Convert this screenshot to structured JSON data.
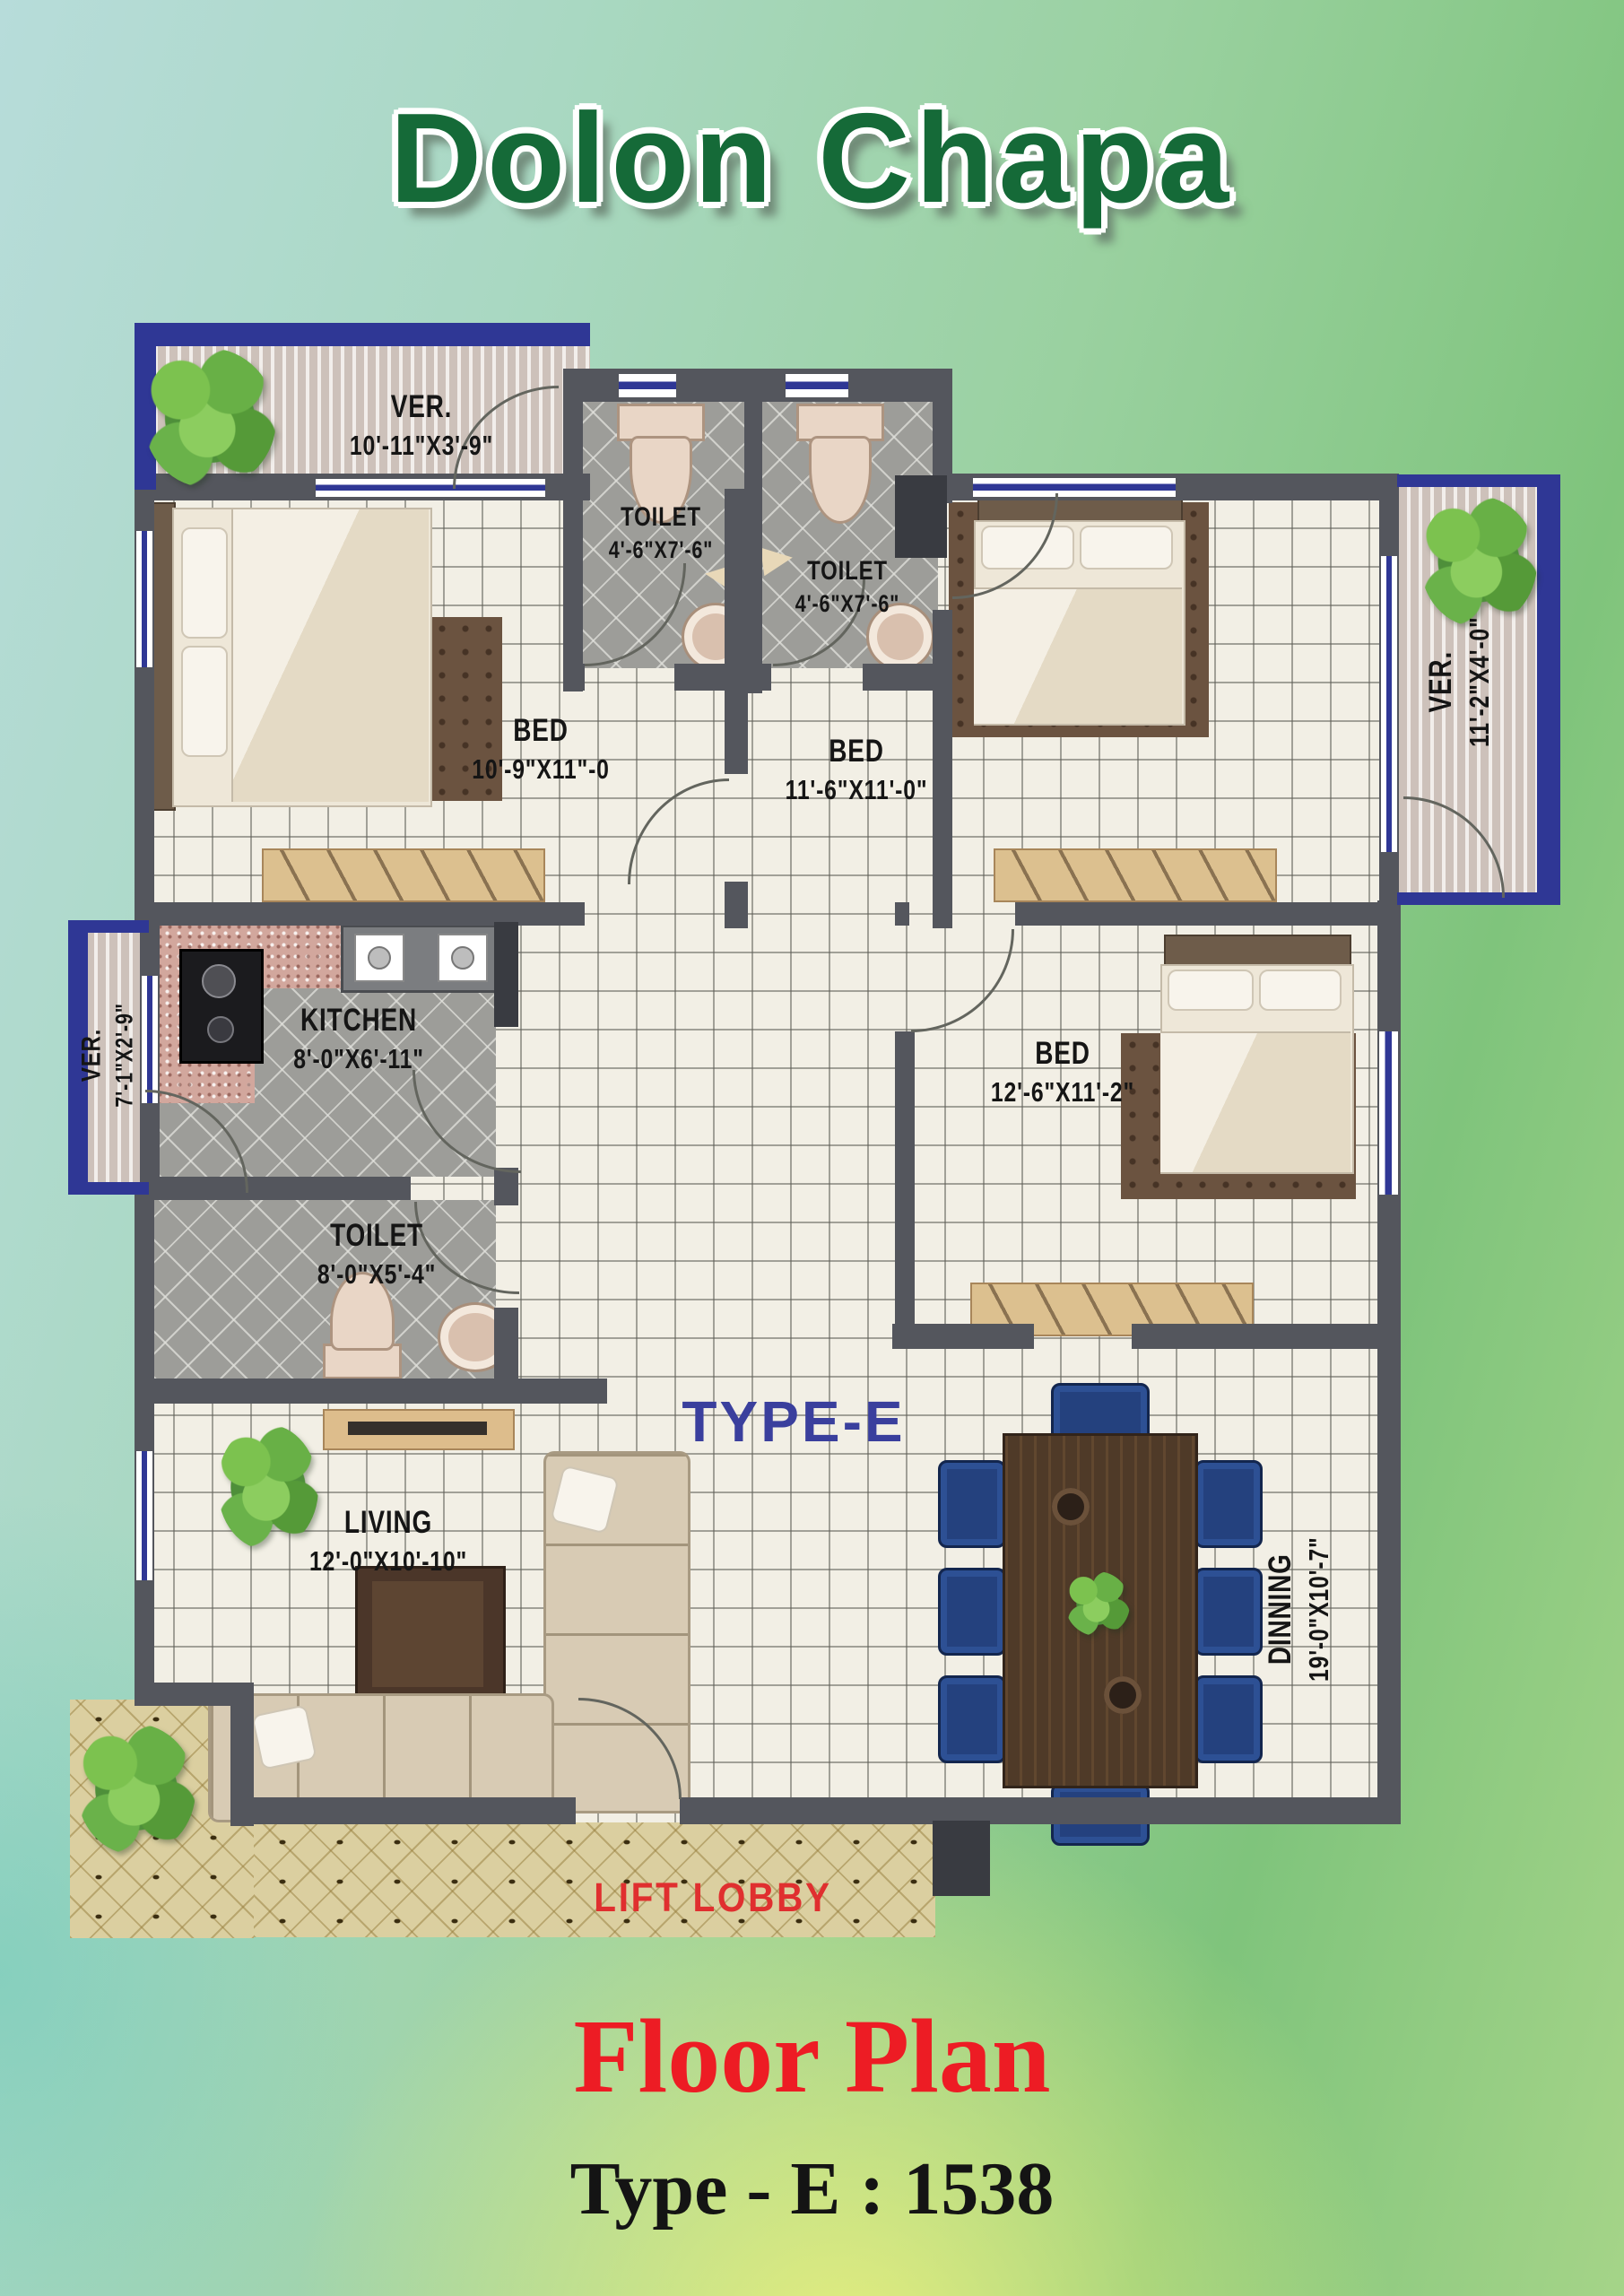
{
  "title": "Dolon Chapa",
  "plan": {
    "type_watermark": "TYPE-E",
    "lift_lobby_label": "LIFT LOBBY",
    "rooms": {
      "ver_top": {
        "label": "VER.",
        "dims": "10'-11\"X3'-9\""
      },
      "toilet_a": {
        "label": "TOILET",
        "dims": "4'-6\"X7'-6\""
      },
      "toilet_b": {
        "label": "TOILET",
        "dims": "4'-6\"X7'-6\""
      },
      "bed_a": {
        "label": "BED",
        "dims": "10'-9\"X11\"-0"
      },
      "bed_b": {
        "label": "BED",
        "dims": "11'-6\"X11'-0\""
      },
      "ver_right": {
        "label": "VER.",
        "dims": "11'-2\"X4'-0\""
      },
      "ver_left": {
        "label": "VER.",
        "dims": "7'-1\"X2'-9\""
      },
      "kitchen": {
        "label": "KITCHEN",
        "dims": "8'-0\"X6'-11\""
      },
      "toilet_c": {
        "label": "TOILET",
        "dims": "8'-0\"X5'-4\""
      },
      "bed_c": {
        "label": "BED",
        "dims": "12'-6\"X11'-2\""
      },
      "living": {
        "label": "LIVING",
        "dims": "12'-0\"X10'-10\""
      },
      "dining": {
        "label": "DINNING",
        "dims": "19'-0\"X10'-7\""
      }
    }
  },
  "footer": {
    "heading": "Floor Plan",
    "subheading": "Type - E : 1538"
  },
  "colors": {
    "accent_blue": "#2f3795",
    "wall_gray": "#54565d",
    "title_green": "#156a38",
    "heading_red": "#ed1c24",
    "lobby_text_red": "#e02f2f",
    "watermark_blue": "#3a3f9d"
  }
}
